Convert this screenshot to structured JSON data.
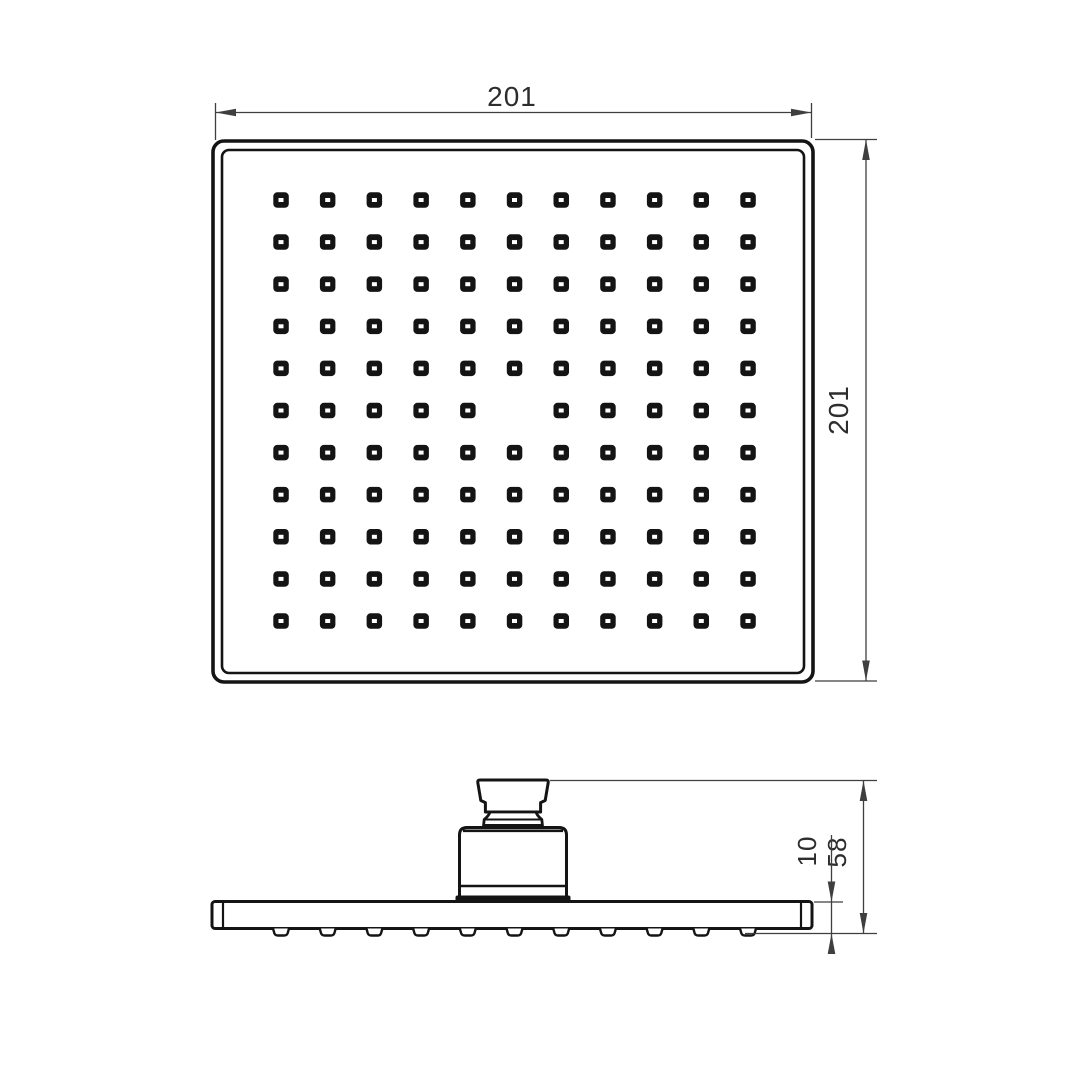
{
  "drawing": {
    "subject": "Square overhead rain shower head - technical drawing, top and side views",
    "colors": {
      "line": "#141414",
      "dimension": "#3f3f3f",
      "background": "#ffffff"
    },
    "views": {
      "top": {
        "name": "top-view-spray-face",
        "width_label": "201",
        "height_label": "201",
        "nozzle_grid": {
          "rows": 11,
          "cols": 11,
          "missing_cells": [
            [
              5,
              5
            ]
          ]
        }
      },
      "side": {
        "name": "side-view-profile",
        "overall_height_label": "58",
        "plate_thickness_label": "10",
        "spray_nozzle_count": 11
      }
    }
  }
}
